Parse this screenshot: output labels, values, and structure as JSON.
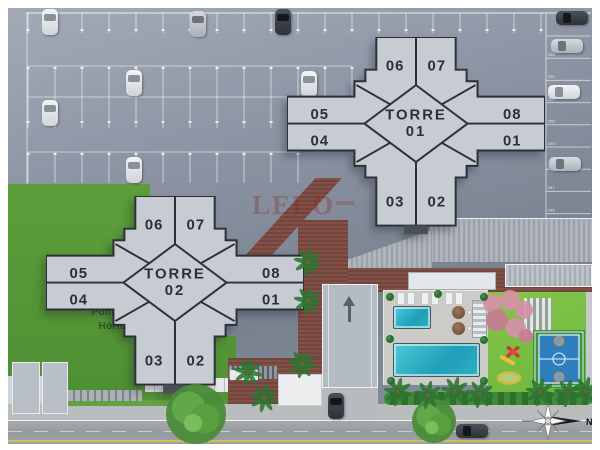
{
  "labels": {
    "orchard_line1": "Pomar e",
    "orchard_line2": "Horta",
    "compass": "N",
    "watermark": "LELO"
  },
  "towers": [
    {
      "name": [
        "TORRE",
        "01"
      ],
      "units": [
        "06",
        "07",
        "05",
        "04",
        "08",
        "01",
        "03",
        "02"
      ]
    },
    {
      "name": [
        "TORRE",
        "02"
      ],
      "units": [
        "06",
        "07",
        "05",
        "04",
        "08",
        "01",
        "03",
        "02"
      ]
    }
  ],
  "colors": {
    "asphalt": "#8891a1",
    "building": "#c7cbd2",
    "outline": "#2c3037",
    "grass_dark": "#559536",
    "lawn": "#7cc143",
    "pool": "#2fb0c4",
    "brick": "#7c4a41",
    "deck": "#cbccc7",
    "street": "#9da1a6",
    "pink_trees": "#d891a8"
  },
  "parking": {
    "right_column_numbers": [
      "253",
      "252",
      "251",
      "250",
      "249",
      "248",
      "247",
      "246",
      "245",
      "244"
    ],
    "rows": [
      {
        "name": "top-row",
        "x": 28,
        "y": 13,
        "stalls": 19,
        "pitch": 27,
        "depth": 20,
        "tick_y": 29
      },
      {
        "name": "mid-upper",
        "x": 28,
        "y": 66,
        "stalls": 12,
        "pitch": 27,
        "depth": 31,
        "tick_y": 67
      },
      {
        "name": "mid-lower",
        "x": 28,
        "y": 97,
        "stalls": 10,
        "pitch": 27,
        "depth": 31,
        "tick_y": 121
      },
      {
        "name": "lower-row",
        "x": 28,
        "y": 152,
        "stalls": 10,
        "pitch": 27,
        "depth": 31,
        "tick_y": 153
      }
    ],
    "cars": [
      {
        "x": 42,
        "y": 9,
        "o": "v",
        "c": "white"
      },
      {
        "x": 190,
        "y": 11,
        "o": "v",
        "c": "silver"
      },
      {
        "x": 275,
        "y": 9,
        "o": "v",
        "c": "dark"
      },
      {
        "x": 556,
        "y": 11,
        "o": "h",
        "c": "dark"
      },
      {
        "x": 301,
        "y": 71,
        "o": "v",
        "c": "white"
      },
      {
        "x": 126,
        "y": 70,
        "o": "v",
        "c": "white"
      },
      {
        "x": 42,
        "y": 100,
        "o": "v",
        "c": "white"
      },
      {
        "x": 126,
        "y": 157,
        "o": "v",
        "c": "white"
      },
      {
        "x": 551,
        "y": 39,
        "o": "h",
        "c": "silver"
      },
      {
        "x": 548,
        "y": 85,
        "o": "h",
        "c": "white"
      },
      {
        "x": 549,
        "y": 157,
        "o": "h",
        "c": "silver"
      },
      {
        "x": 328,
        "y": 393,
        "o": "v",
        "c": "dark"
      },
      {
        "x": 456,
        "y": 424,
        "o": "h",
        "c": "dark"
      }
    ]
  },
  "landscape": {
    "palms": [
      [
        248,
        372
      ],
      [
        264,
        398
      ],
      [
        302,
        364
      ],
      [
        308,
        262
      ],
      [
        308,
        301
      ],
      [
        398,
        392
      ],
      [
        428,
        395
      ],
      [
        455,
        391
      ],
      [
        480,
        394
      ],
      [
        540,
        392
      ],
      [
        568,
        393
      ],
      [
        586,
        391
      ]
    ],
    "trees": [
      [
        196,
        414,
        30
      ],
      [
        434,
        421,
        22
      ]
    ],
    "shrubs": [
      [
        390,
        297
      ],
      [
        390,
        339
      ],
      [
        391,
        381
      ],
      [
        484,
        297
      ],
      [
        484,
        340
      ],
      [
        484,
        381
      ],
      [
        438,
        294
      ]
    ]
  }
}
